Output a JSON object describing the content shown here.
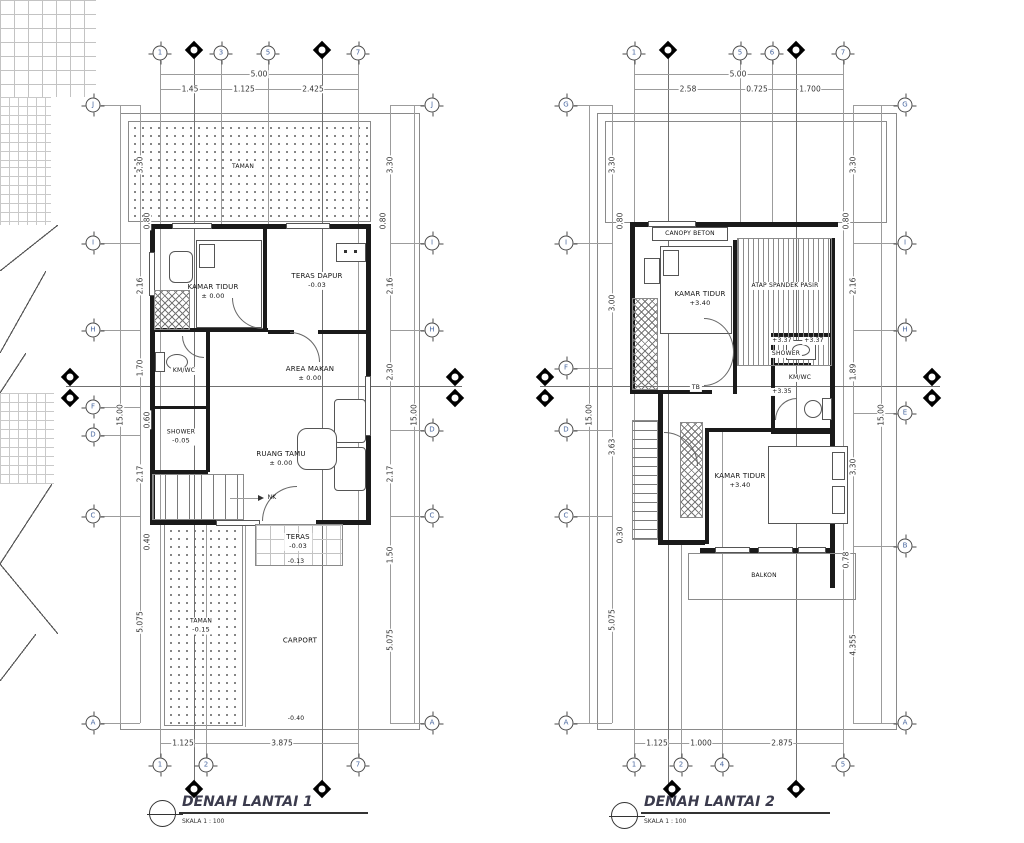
{
  "drawing": {
    "p1": {
      "title": "DENAH LANTAI 1",
      "scale": "SKALA 1 : 100",
      "top_bubbles": [
        "1",
        "3",
        "5",
        "7"
      ],
      "bottom_bubbles": [
        "1",
        "2",
        "7"
      ],
      "left_bubbles": [
        "J",
        "I",
        "H",
        "F",
        "D",
        "C",
        "A"
      ],
      "right_bubbles": [
        "J",
        "I",
        "H",
        "D",
        "C",
        "A"
      ],
      "dims": {
        "top_total": "5.00",
        "top": [
          "1.45",
          "1.125",
          "2.425"
        ],
        "left": [
          "3.30",
          "0.80",
          "2.16",
          "1.70",
          "0.60",
          "2.17",
          "0.40",
          "5.075"
        ],
        "left_total": "15.00",
        "right": [
          "3.30",
          "0.80",
          "2.16",
          "2.30",
          "2.17",
          "1.50",
          "5.075"
        ],
        "right_total": "15.00",
        "bottom": [
          "1.125",
          "3.875"
        ]
      },
      "labels": {
        "taman_atas": "TAMAN",
        "kamar_tidur": {
          "name": "KAMAR TIDUR",
          "level": "± 0.00"
        },
        "teras_dapur": {
          "name": "TERAS DAPUR",
          "level": "-0.03"
        },
        "km_wc": "KM/WC",
        "shower": {
          "name": "SHOWER",
          "level": "-0.05"
        },
        "area_makan": {
          "name": "AREA MAKAN",
          "level": "± 0.00"
        },
        "ruang_tamu": {
          "name": "RUANG TAMU",
          "level": "± 0.00"
        },
        "teras": {
          "name": "TERAS",
          "level": "-0.03"
        },
        "teras_level2": "-0.13",
        "taman_bawah": {
          "name": "TAMAN",
          "level": "-0.15"
        },
        "carport": "CARPORT",
        "carport_level": "-0.40",
        "stair": "NK"
      }
    },
    "p2": {
      "title": "DENAH LANTAI 2",
      "scale": "SKALA 1 : 100",
      "top_bubbles": [
        "1",
        "5",
        "6",
        "7"
      ],
      "bottom_bubbles": [
        "1",
        "2",
        "4",
        "5"
      ],
      "left_bubbles": [
        "G",
        "I",
        "F",
        "D",
        "C",
        "A"
      ],
      "right_bubbles": [
        "G",
        "I",
        "H",
        "E",
        "B",
        "A"
      ],
      "dims": {
        "top_total": "5.00",
        "top": [
          "2.58",
          "0.725",
          "1.700"
        ],
        "left": [
          "3.30",
          "0.80",
          "3.00",
          "3.63",
          "0.30",
          "5.075"
        ],
        "left_total": "15.00",
        "right": [
          "3.30",
          "0.80",
          "2.16",
          "1.89",
          "3.30",
          "0.78",
          "4.355"
        ],
        "right_total": "15.00",
        "bottom": [
          "1.125",
          "1.000",
          "2.875"
        ]
      },
      "labels": {
        "canopy": "CANOPY BETON",
        "kamar_tidur_1": {
          "name": "KAMAR TIDUR",
          "level": "+3.40"
        },
        "atap": "ATAP SPANDEK PASIR",
        "level_tag_1": "+3.37",
        "level_tag_2": "+3.37",
        "shower": "SHOWER",
        "km_wc": "KM/WC",
        "km_level": "+3.35",
        "tb": "TB",
        "kamar_tidur_2": {
          "name": "KAMAR TIDUR",
          "level": "+3.40"
        },
        "balkon": "BALKON"
      }
    }
  }
}
